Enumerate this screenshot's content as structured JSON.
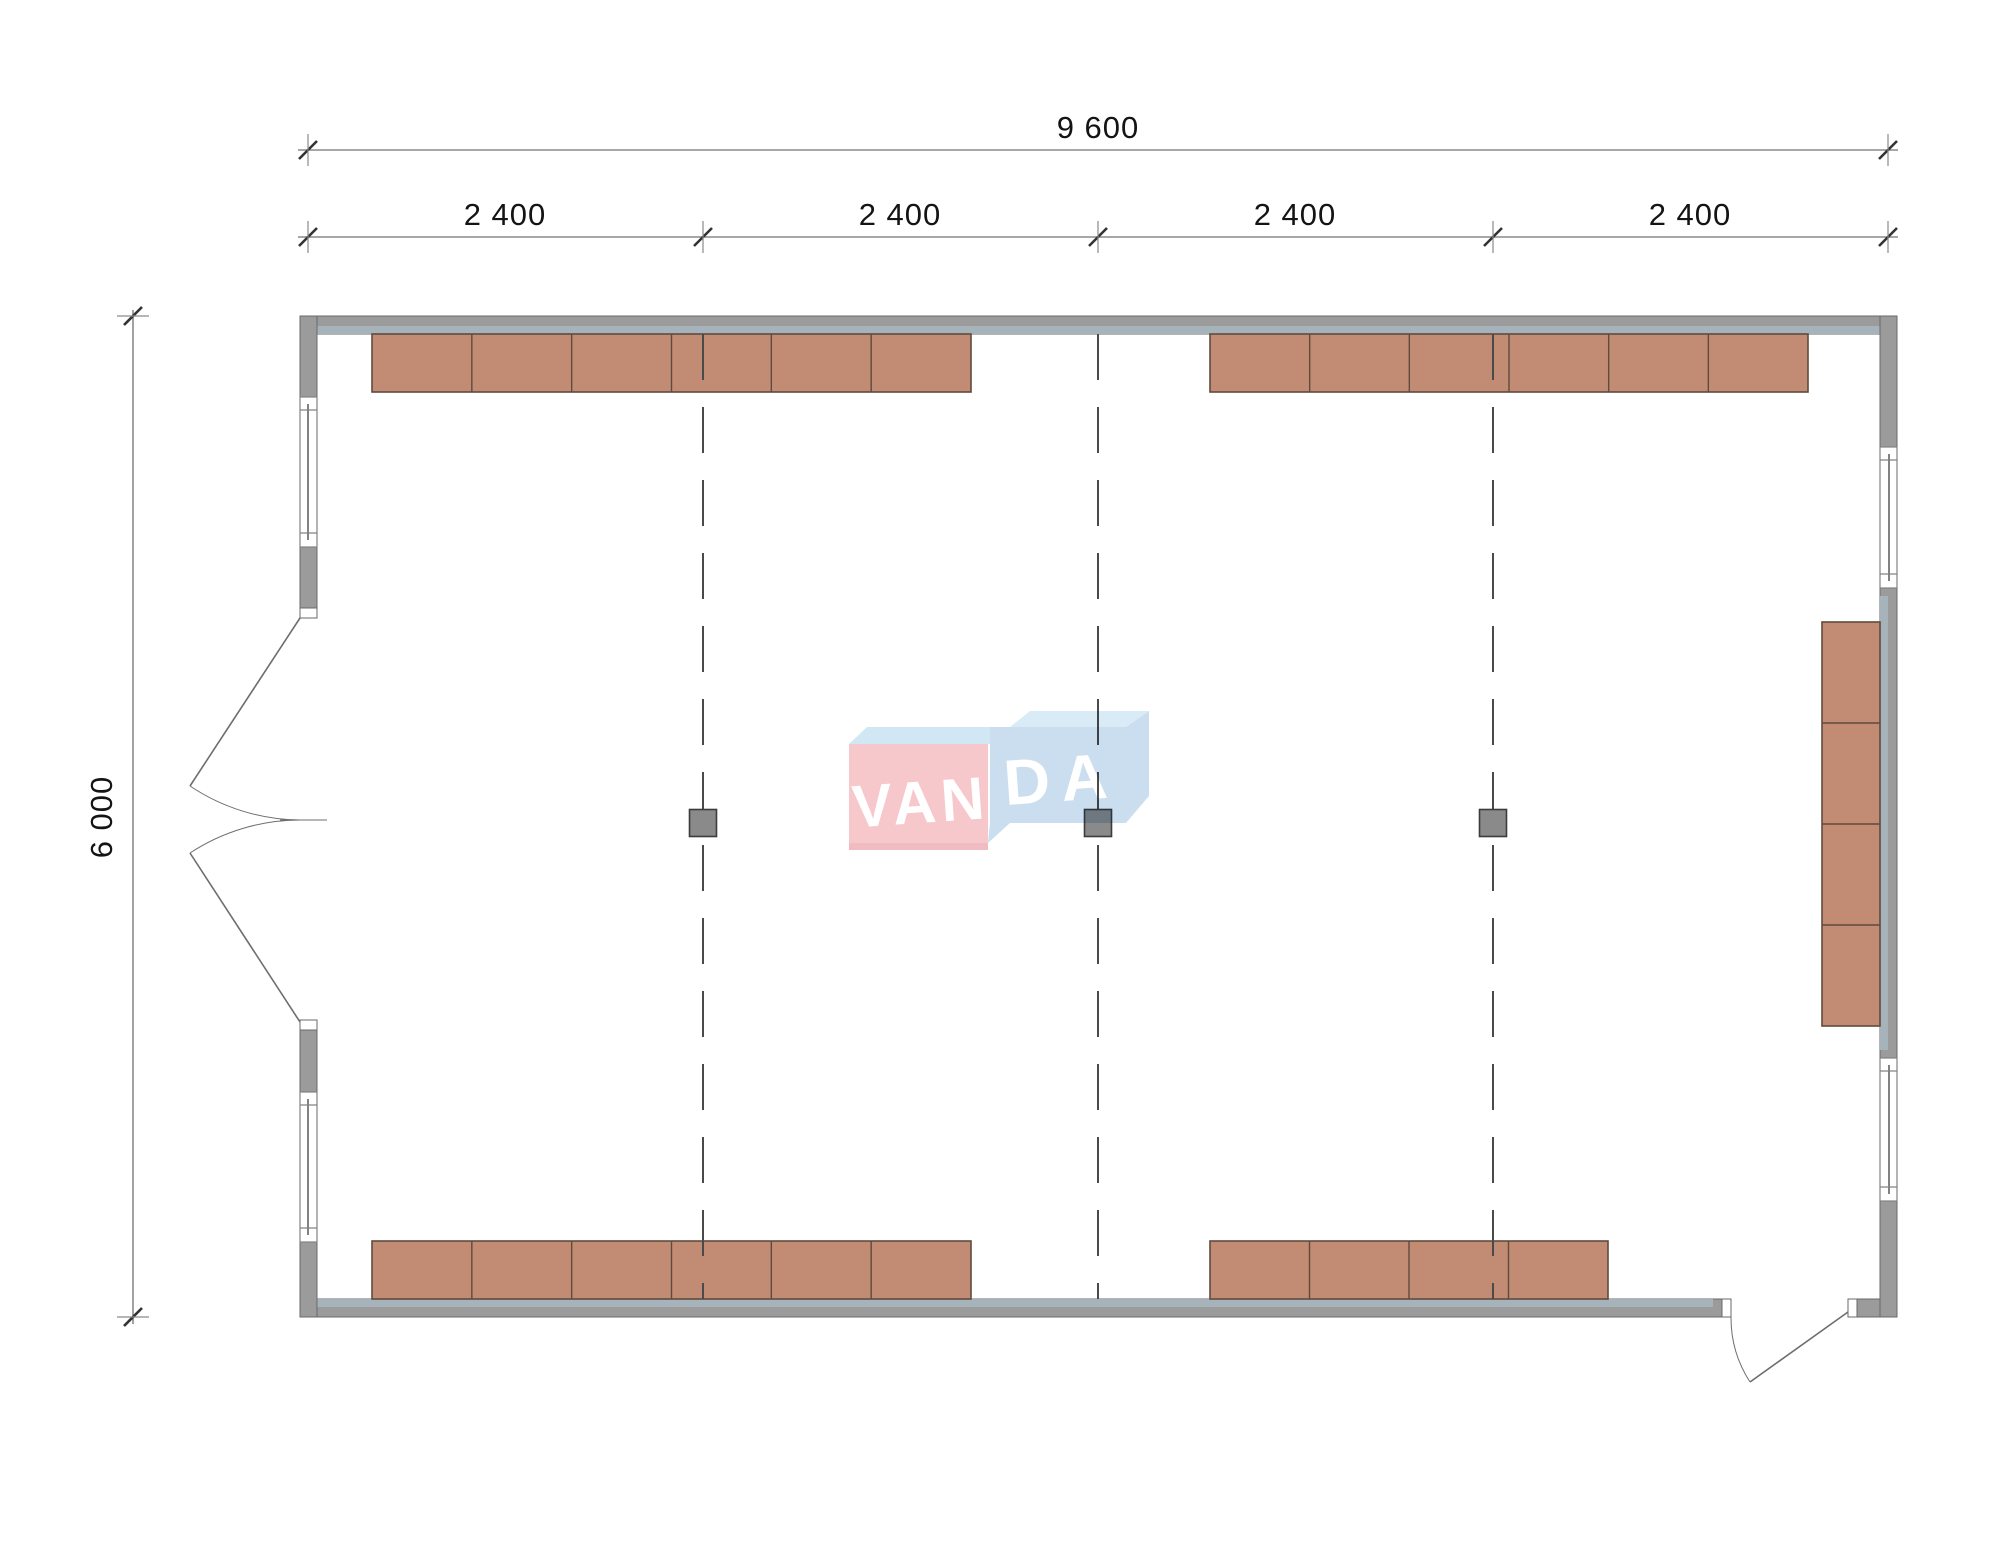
{
  "app": {
    "background": "#ffffff",
    "description_label": "floor plan drawing"
  },
  "colors": {
    "wall_fill": "#9b9b9b",
    "wall_stroke": "#6a6a6a",
    "wall_strip": "#a6b3ba",
    "window_stroke": "#828282",
    "cabinet_fill": "#c28c74",
    "cabinet_stroke": "#5f4a3e",
    "grid_line": "#4a4a4a",
    "column_fill": "#8a8a8a",
    "column_stroke": "#3c3c3c",
    "dim_line": "#8a8a8a",
    "dim_tick": "#333333",
    "dim_text": "#141414",
    "door_line": "#6e6e6e",
    "logo_pink": "#f6c7cb",
    "logo_pink_shadow": "#f0bcc1",
    "logo_blue": "#cbdeef",
    "logo_blue_top": "#d9ebf6",
    "logo_band": "#d2e7f4",
    "logo_text": "#ffffff"
  },
  "dimensions": {
    "total_width": {
      "label": "9 600"
    },
    "segments": [
      {
        "label": "2 400"
      },
      {
        "label": "2 400"
      },
      {
        "label": "2 400"
      },
      {
        "label": "2 400"
      }
    ],
    "total_depth": {
      "label": "6 000"
    }
  },
  "plan": {
    "units": "mm",
    "overall_width_mm": 9600,
    "overall_depth_mm": 6000,
    "bay_module_mm": 2400,
    "axes_x": [
      308,
      703,
      1098,
      1493,
      1888
    ],
    "interior_axes_x": [
      703,
      1098,
      1493
    ],
    "grid_top_y": 334,
    "grid_bottom_y": 1299,
    "column_size": 27,
    "columns": [
      {
        "x": 703,
        "y": 823
      },
      {
        "x": 1098,
        "y": 823
      },
      {
        "x": 1493,
        "y": 823
      }
    ],
    "cabinet_runs": [
      {
        "id": "top-left",
        "orient": "h",
        "x": 372,
        "y": 334,
        "length": 599,
        "depth": 58,
        "modules": 6
      },
      {
        "id": "top-right",
        "orient": "h",
        "x": 1210,
        "y": 334,
        "length": 598,
        "depth": 58,
        "modules": 6
      },
      {
        "id": "bottom-left",
        "orient": "h",
        "x": 372,
        "y": 1241,
        "length": 599,
        "depth": 58,
        "modules": 6
      },
      {
        "id": "bottom-right",
        "orient": "h",
        "x": 1210,
        "y": 1241,
        "length": 398,
        "depth": 58,
        "modules": 4
      },
      {
        "id": "right-wall",
        "orient": "v",
        "x": 1822,
        "y": 622,
        "length": 404,
        "depth": 58,
        "modules": 4
      }
    ]
  },
  "logo": {
    "left": "VAN",
    "right": "DA"
  }
}
